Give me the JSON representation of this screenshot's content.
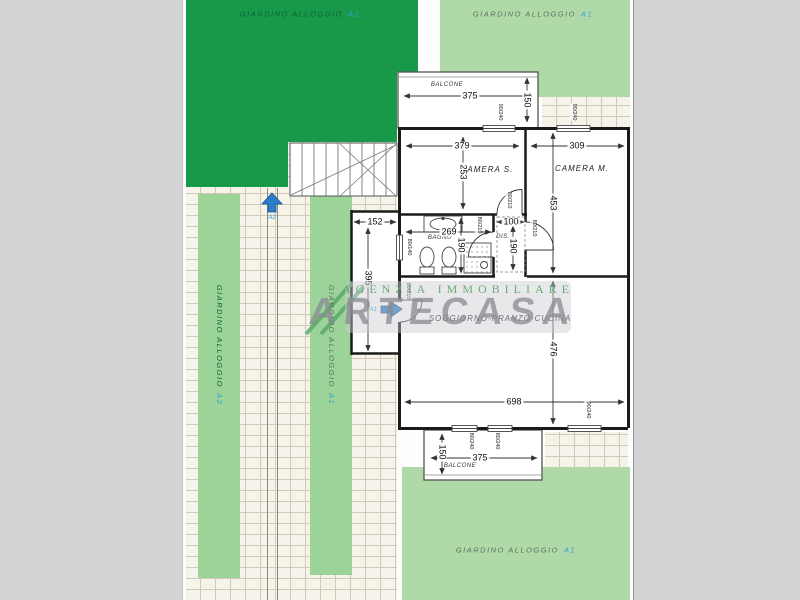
{
  "colors": {
    "bg": "#D3D3D6",
    "dark_green": "#18994A",
    "light_green": "#AFD9A7",
    "strip_green": "#9BD399",
    "brick": "#F6F3EA",
    "brick_line": "#CFC9B6",
    "wall": "#1A1A1A",
    "unit_blue": "#2F9FD6",
    "marker_blue": "#2E7CC9",
    "wm_green": "#57A868",
    "wm_gray": "#8A8A92"
  },
  "gardens": {
    "top_left": {
      "label": "GIARDINO ALLOGGIO",
      "unit": "A2"
    },
    "top_right": {
      "label": "GIARDINO ALLOGGIO",
      "unit": "A1"
    },
    "bottom_right": {
      "label": "GIARDINO ALLOGGIO",
      "unit": "A1"
    },
    "strip_dark": {
      "label": "GIARDINO ALLOGGIO",
      "unit": "A2"
    },
    "strip_light": {
      "label": "GIARDINO ALLOGGIO",
      "unit": "A1"
    }
  },
  "rooms": {
    "balcone_top": "BALCONE",
    "camera_s": "CAMERA  S.",
    "camera_m": "CAMERA  M.",
    "bagno": "BAGNO",
    "dis": "DIS.",
    "soggiorno": "SOGGIORNO-PRANZO-CUCINA",
    "balcone_bottom": "BALCONE"
  },
  "dims": {
    "balcone_top_w": "375",
    "balcone_top_h": "150",
    "camera_s_w": "379",
    "camera_s_h": "253",
    "camera_m_w": "309",
    "camera_m_h": "453",
    "entry_w": "152",
    "entry_h": "395",
    "bagno_w": "269",
    "bagno_h": "190",
    "dis_w": "100",
    "dis_h": "190",
    "soggiorno_h": "476",
    "soggiorno_w": "698",
    "balcone_bottom_w": "375",
    "balcone_bottom_h": "150"
  },
  "openings": {
    "window_90_240": "90/240",
    "window_80_240": "80/240",
    "window_bagno": "80/140",
    "door_80_210": "80/210"
  },
  "markers": {
    "path_arrow_label": "A2",
    "entrance_arrow_label": "A1"
  },
  "watermark": {
    "agency_line": "AGENZIA IMMOBILIARE",
    "brand": "ARTECASA"
  }
}
